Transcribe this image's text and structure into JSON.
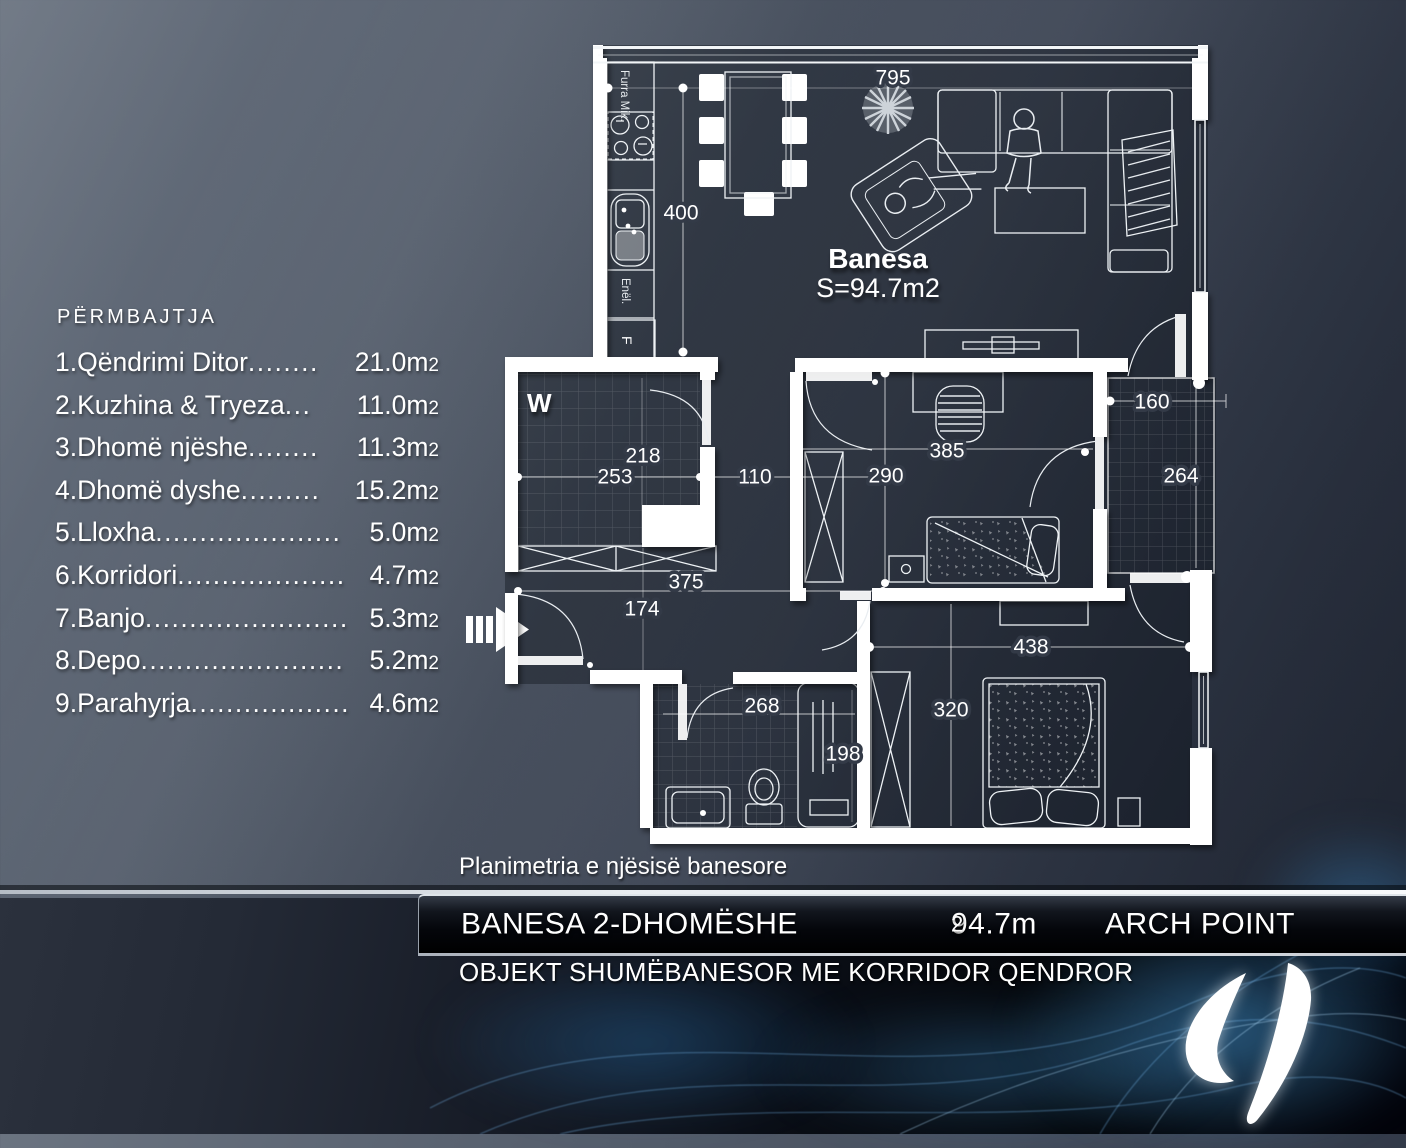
{
  "colors": {
    "background_top": "#6b7481",
    "background_bottom": "#202634",
    "wall_white": "#ffffff",
    "accent_blue": "#2e8fd0",
    "bar_black": "#04060b",
    "text": "#ffffff"
  },
  "legend": {
    "heading": "PËRMBAJTJA",
    "items": [
      {
        "label": "1.Qëndrimi Ditor",
        "dots": "........",
        "area": "21.0m",
        "sub": "2"
      },
      {
        "label": "2.Kuzhina & Tryeza",
        "dots": "...",
        "area": "11.0m",
        "sub": "2"
      },
      {
        "label": "3.Dhomë njëshe",
        "dots": "........",
        "area": "11.3m",
        "sub": "2"
      },
      {
        "label": "4.Dhomë dyshe",
        "dots": ".........",
        "area": "15.2m",
        "sub": "2"
      },
      {
        "label": "5.Lloxha",
        "dots": ".....................",
        "area": "5.0m",
        "sub": "2"
      },
      {
        "label": "6.Korridori",
        "dots": "...................",
        "area": "4.7m",
        "sub": "2"
      },
      {
        "label": "7.Banjo",
        "dots": ".......................",
        "area": "5.3m",
        "sub": "2"
      },
      {
        "label": "8.Depo",
        "dots": ".......................",
        "area": "5.2m",
        "sub": "2"
      },
      {
        "label": "9.Parahyrja",
        "dots": "..................",
        "area": "4.6m",
        "sub": "2"
      }
    ]
  },
  "plan": {
    "unit_name": "Banesa",
    "unit_area": "S=94.7m2",
    "w_label": "W",
    "kitchen_labels": {
      "oven": "Furra Mik.",
      "dishes": "Enël.",
      "fridge": "F"
    },
    "dims": {
      "living_width": "795",
      "kitchen_height": "400",
      "w_room_height": "218",
      "w_room_width": "253",
      "hall_width": "110",
      "room1_width": "385",
      "room1_height": "290",
      "balcony_width": "160",
      "balcony_height": "264",
      "closet_width": "375",
      "vestibule_height": "174",
      "room2_width": "438",
      "room2_height": "320",
      "bath_width": "268",
      "shower_length": "198"
    }
  },
  "footer": {
    "caption": "Planimetria e njësisë banesore",
    "title": "BANESA 2-DHOMËSHE",
    "area": "94.7m",
    "area_sub": "2",
    "brand": "ARCH POINT",
    "subtitle": "OBJEKT SHUMËBANESOR ME KORRIDOR QENDROR"
  }
}
